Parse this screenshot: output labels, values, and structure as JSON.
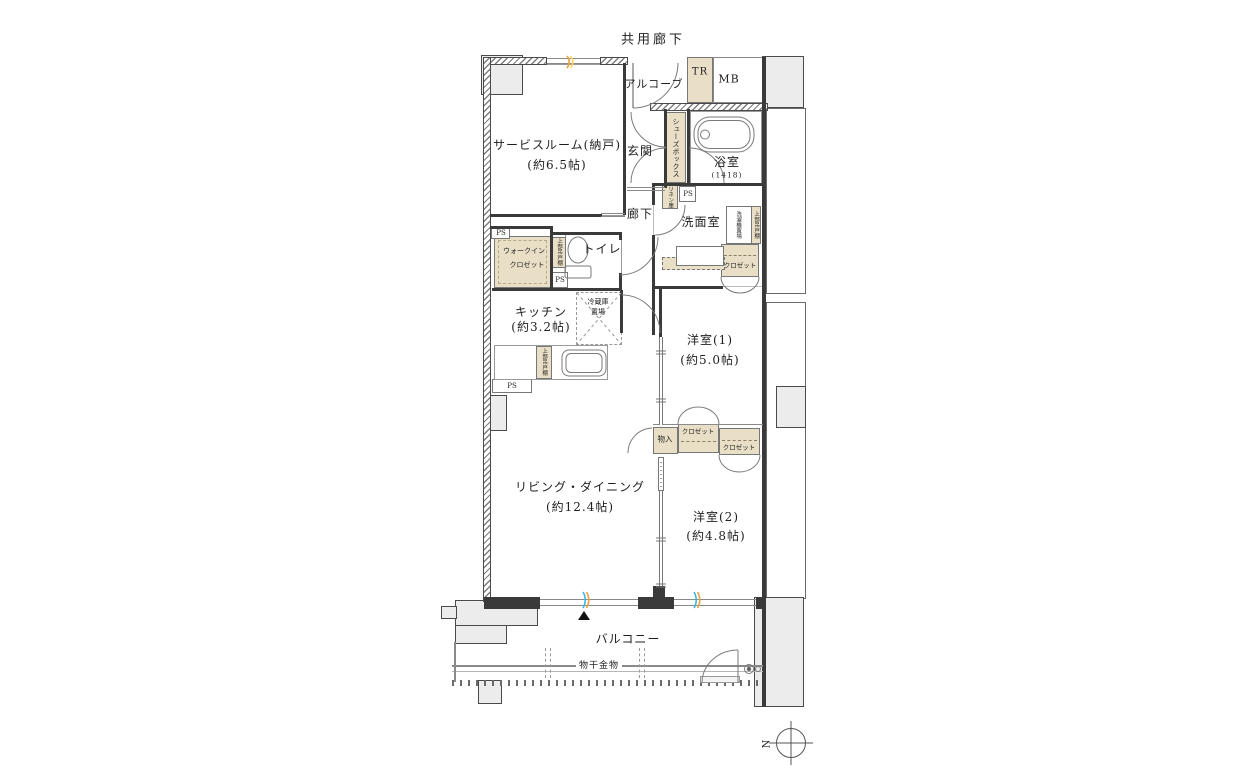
{
  "plan": {
    "common_corridor": "共用廊下",
    "alcove": "アルコーブ",
    "tr": "TR",
    "mb": "MB",
    "service_room": {
      "name": "サービスルーム(納戸)",
      "size": "(約6.5帖)"
    },
    "entrance": "玄関",
    "shoe_box": "シューズボックス",
    "bathroom": {
      "name": "浴室",
      "size": "(1418)"
    },
    "linen": "リネン庫",
    "ps": "PS",
    "hallway": "廊下",
    "washroom": "洗面室",
    "laundry": "洗濯機置場",
    "upper_cabinet": "上部吊戸棚",
    "wic": {
      "line1": "ウォークイン",
      "line2": "クロゼット"
    },
    "toilet": "トイレ",
    "fridge": {
      "line1": "冷蔵庫",
      "line2": "置場"
    },
    "kitchen": {
      "name": "キッチン",
      "size": "(約3.2帖)"
    },
    "bedroom1": {
      "name": "洋室(1)",
      "size": "(約5.0帖)"
    },
    "closet": "クロゼット",
    "storage": "物入",
    "living": {
      "name": "リビング・ダイニング",
      "size": "(約12.4帖)"
    },
    "bedroom2": {
      "name": "洋室(2)",
      "size": "(約4.8帖)"
    },
    "balcony": "バルコニー",
    "drying": "物干金物",
    "compass_n": "N"
  },
  "colors": {
    "storage_fill": "#e9dfc6",
    "concrete_fill": "#ececec",
    "wall": "#3a3a3a",
    "accent_cyan": "#3ab6e4",
    "accent_orange": "#f0a03a"
  }
}
